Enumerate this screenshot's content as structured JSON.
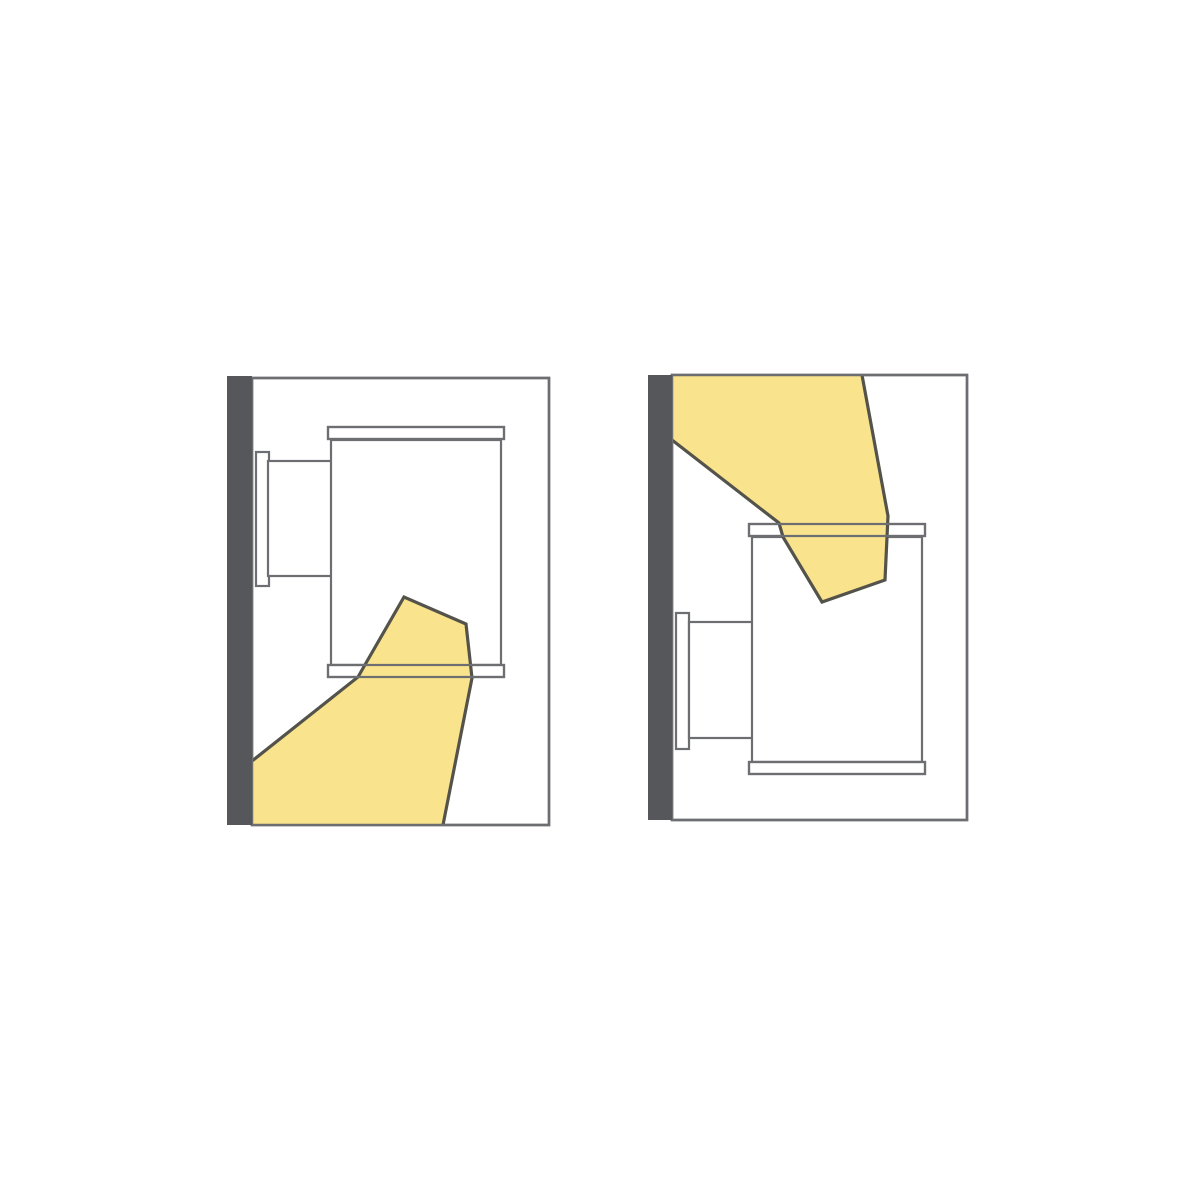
{
  "page": {
    "width": 1200,
    "height": 1200,
    "background": "#ffffff"
  },
  "colors": {
    "wall": "#56575b",
    "outline": "#6d6e72",
    "room_fill": "#ffffff",
    "fixture_fill": "#ffffff",
    "beam_fill": "#f9e38c",
    "beam_outline": "#54534b"
  },
  "strokes": {
    "frame": 2.5,
    "fixture": 2.2,
    "beam": 3.2
  },
  "diagrams": [
    {
      "id": "downlight",
      "name": "downlight",
      "wall": {
        "x": 227,
        "y": 376,
        "w": 25,
        "h": 449
      },
      "frame": {
        "x": 252,
        "y": 378,
        "w": 297,
        "h": 447
      },
      "fixture": {
        "plate": {
          "x": 256,
          "y": 452,
          "w": 13,
          "h": 134
        },
        "arm": {
          "x": 268,
          "y": 461,
          "w": 65,
          "h": 115
        },
        "body": {
          "x": 331,
          "y": 440,
          "w": 170,
          "h": 225
        },
        "top_cap": {
          "x": 328,
          "y": 427,
          "w": 176,
          "h": 12
        },
        "bottom_cap": {
          "x": 328,
          "y": 665,
          "w": 176,
          "h": 12
        }
      },
      "beam": {
        "fill_points": [
          [
            404,
            597
          ],
          [
            466,
            624
          ],
          [
            472,
            678
          ],
          [
            443,
            825
          ],
          [
            252,
            825
          ],
          [
            252,
            761
          ],
          [
            358,
            677
          ],
          [
            366,
            663
          ]
        ],
        "edge_points": [
          [
            252,
            761
          ],
          [
            358,
            677
          ],
          [
            366,
            663
          ],
          [
            404,
            597
          ],
          [
            466,
            624
          ],
          [
            472,
            678
          ],
          [
            443,
            825
          ]
        ]
      }
    },
    {
      "id": "uplight",
      "name": "uplight",
      "wall": {
        "x": 648,
        "y": 375,
        "w": 24,
        "h": 445
      },
      "frame": {
        "x": 672,
        "y": 375,
        "w": 295,
        "h": 445
      },
      "fixture": {
        "plate": {
          "x": 676,
          "y": 613,
          "w": 13,
          "h": 136
        },
        "arm": {
          "x": 689,
          "y": 622,
          "w": 65,
          "h": 116
        },
        "body": {
          "x": 752,
          "y": 537,
          "w": 170,
          "h": 225
        },
        "top_cap": {
          "x": 749,
          "y": 524,
          "w": 176,
          "h": 12
        },
        "bottom_cap": {
          "x": 749,
          "y": 762,
          "w": 176,
          "h": 12
        }
      },
      "beam": {
        "fill_points": [
          [
            672,
            375
          ],
          [
            862,
            375
          ],
          [
            888,
            516
          ],
          [
            885,
            580
          ],
          [
            822,
            602
          ],
          [
            783,
            537
          ],
          [
            779,
            523
          ],
          [
            672,
            440
          ]
        ],
        "edge_points": [
          [
            672,
            440
          ],
          [
            779,
            523
          ],
          [
            783,
            537
          ],
          [
            822,
            602
          ],
          [
            885,
            580
          ],
          [
            888,
            516
          ],
          [
            862,
            375
          ]
        ]
      }
    }
  ]
}
